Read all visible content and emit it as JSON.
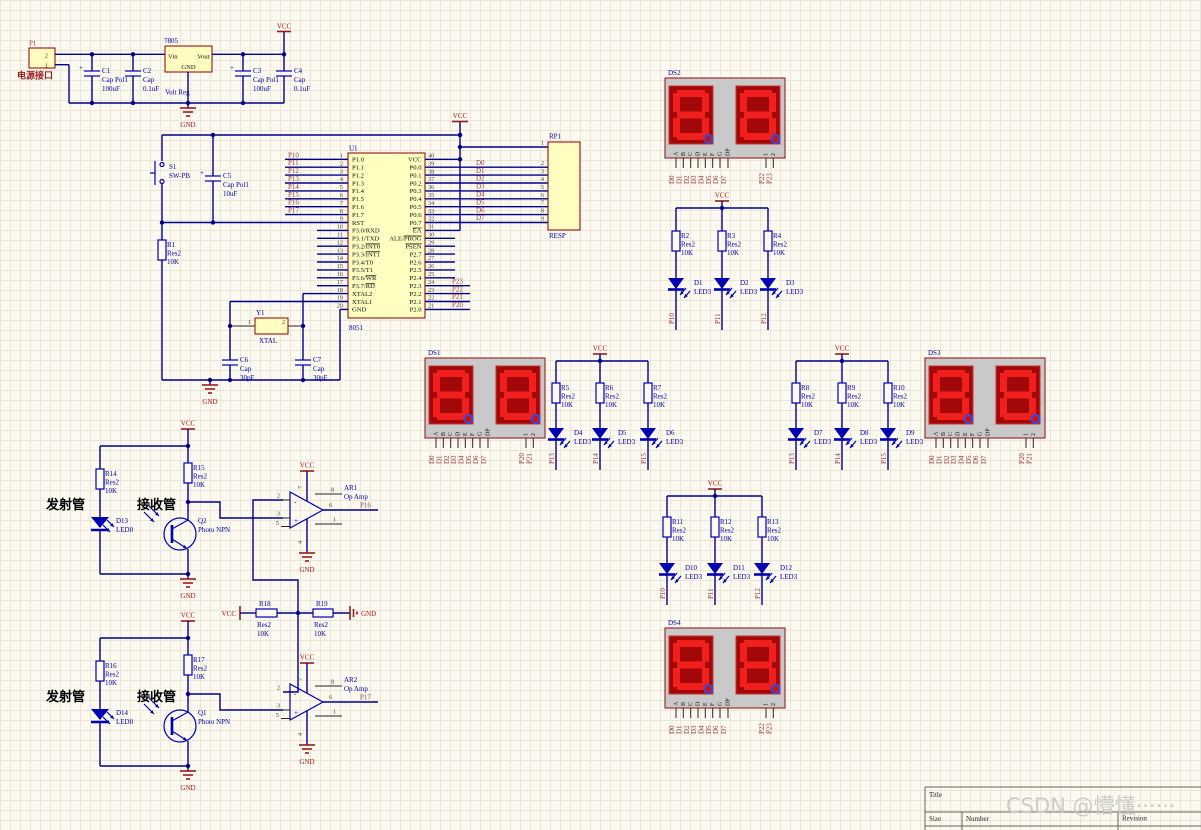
{
  "power": {
    "vcc": "VCC",
    "gnd": "GND"
  },
  "power_section": {
    "p1": {
      "ref": "P1",
      "label": "电源接口",
      "pin2": "2",
      "pin1": "1"
    },
    "c1": {
      "ref": "C1",
      "type": "Cap Pol1",
      "value": "100uF"
    },
    "c2": {
      "ref": "C2",
      "type": "Cap",
      "value": "0.1uF"
    },
    "vreg": {
      "ref": "7805",
      "pin_vin": "Vin",
      "pin_vout": "Vout",
      "pin_gnd": "GND",
      "desc": "Volt Reg"
    },
    "c3": {
      "ref": "C3",
      "type": "Cap Pol1",
      "value": "100uF"
    },
    "c4": {
      "ref": "C4",
      "type": "Cap",
      "value": "0.1uF"
    }
  },
  "reset_section": {
    "s1": {
      "ref": "S1",
      "value": "SW-PB"
    },
    "c5": {
      "ref": "C5",
      "type": "Cap Pol1",
      "value": "10uF"
    },
    "r1": {
      "ref": "R1",
      "type": "Res2",
      "value": "10K"
    }
  },
  "xtal_section": {
    "y1": {
      "ref": "Y1",
      "value": "XTAL",
      "pin1": "1",
      "pin2": "2"
    },
    "c6": {
      "ref": "C6",
      "type": "Cap",
      "value": "30pF"
    },
    "c7": {
      "ref": "C7",
      "type": "Cap",
      "value": "30pF"
    }
  },
  "mcu": {
    "ref": "U1",
    "value": "8051",
    "left_pins": [
      {
        "n": "1",
        "name": "P1.0",
        "net": "P10"
      },
      {
        "n": "2",
        "name": "P1.1",
        "net": "P11"
      },
      {
        "n": "3",
        "name": "P1.2",
        "net": "P12"
      },
      {
        "n": "4",
        "name": "P1.3",
        "net": "P13"
      },
      {
        "n": "5",
        "name": "P1.4",
        "net": "P14"
      },
      {
        "n": "6",
        "name": "P1.5",
        "net": "P15"
      },
      {
        "n": "7",
        "name": "P1.6",
        "net": "P16"
      },
      {
        "n": "8",
        "name": "P1.7",
        "net": "P17"
      },
      {
        "n": "9",
        "name": "RST"
      },
      {
        "n": "10",
        "name": "P3.0/RXD"
      },
      {
        "n": "11",
        "name": "P3.1/TXD"
      },
      {
        "n": "12",
        "name": "P3.2/INT0",
        "bar": "INT0"
      },
      {
        "n": "13",
        "name": "P3.3/INT1",
        "bar": "INT1"
      },
      {
        "n": "14",
        "name": "P3.4/T0"
      },
      {
        "n": "15",
        "name": "P3.5/T1"
      },
      {
        "n": "16",
        "name": "P3.6/WR",
        "bar": "WR"
      },
      {
        "n": "17",
        "name": "P3.7/RD",
        "bar": "RD"
      },
      {
        "n": "18",
        "name": "XTAL2"
      },
      {
        "n": "19",
        "name": "XTAL1"
      },
      {
        "n": "20",
        "name": "GND"
      }
    ],
    "right_pins": [
      {
        "n": "40",
        "name": "VCC"
      },
      {
        "n": "39",
        "name": "P0.0",
        "net": "D0"
      },
      {
        "n": "38",
        "name": "P0.1",
        "net": "D1"
      },
      {
        "n": "37",
        "name": "P0.2",
        "net": "D2"
      },
      {
        "n": "36",
        "name": "P0.3",
        "net": "D3"
      },
      {
        "n": "35",
        "name": "P0.4",
        "net": "D4"
      },
      {
        "n": "34",
        "name": "P0.5",
        "net": "D5"
      },
      {
        "n": "33",
        "name": "P0.6",
        "net": "D6"
      },
      {
        "n": "32",
        "name": "P0.7",
        "net": "D7"
      },
      {
        "n": "31",
        "name": "EA",
        "bar": "EA"
      },
      {
        "n": "30",
        "name": "ALE/PROG",
        "bar": "PROG"
      },
      {
        "n": "29",
        "name": "PSEN",
        "bar": "PSEN"
      },
      {
        "n": "28",
        "name": "P2.7"
      },
      {
        "n": "27",
        "name": "P2.6"
      },
      {
        "n": "26",
        "name": "P2.5"
      },
      {
        "n": "25",
        "name": "P2.4"
      },
      {
        "n": "24",
        "name": "P2.3",
        "net": "P23"
      },
      {
        "n": "23",
        "name": "P2.2",
        "net": "P22"
      },
      {
        "n": "22",
        "name": "P2.1",
        "net": "P21"
      },
      {
        "n": "21",
        "name": "P2.0",
        "net": "P20"
      }
    ]
  },
  "rp": {
    "ref": "RP1",
    "value": "RESP",
    "pin1": "1",
    "pins": [
      "2",
      "3",
      "4",
      "5",
      "6",
      "7",
      "8",
      "9"
    ]
  },
  "displays": [
    {
      "ref": "DS1",
      "segment_pins": [
        "A",
        "B",
        "C",
        "D",
        "E",
        "F",
        "G",
        "DP"
      ],
      "select_pins": [
        "1",
        "2"
      ],
      "segment_nets": [
        "D0",
        "D1",
        "D2",
        "D3",
        "D4",
        "D5",
        "D6",
        "D7"
      ],
      "select_nets": [
        "P20",
        "P21"
      ]
    },
    {
      "ref": "DS2",
      "segment_pins": [
        "A",
        "B",
        "C",
        "D",
        "E",
        "F",
        "G",
        "DP"
      ],
      "select_pins": [
        "1",
        "2"
      ],
      "segment_nets": [
        "D0",
        "D1",
        "D2",
        "D3",
        "D4",
        "D5",
        "D6",
        "D7"
      ],
      "select_nets": [
        "P22",
        "P23"
      ]
    },
    {
      "ref": "DS3",
      "segment_pins": [
        "A",
        "B",
        "C",
        "D",
        "E",
        "F",
        "G",
        "DP"
      ],
      "select_pins": [
        "1",
        "2"
      ],
      "segment_nets": [
        "D0",
        "D1",
        "D2",
        "D3",
        "D4",
        "D5",
        "D6",
        "D7"
      ],
      "select_nets": [
        "P20",
        "P21"
      ]
    },
    {
      "ref": "DS4",
      "segment_pins": [
        "A",
        "B",
        "C",
        "D",
        "E",
        "F",
        "G",
        "DP"
      ],
      "select_pins": [
        "1",
        "2"
      ],
      "segment_nets": [
        "D0",
        "D1",
        "D2",
        "D3",
        "D4",
        "D5",
        "D6",
        "D7"
      ],
      "select_nets": [
        "P22",
        "P23"
      ]
    }
  ],
  "led_groups": [
    {
      "resistors": [
        {
          "ref": "R2",
          "type": "Res2",
          "value": "10K"
        },
        {
          "ref": "R3",
          "type": "Res2",
          "value": "10K"
        },
        {
          "ref": "R4",
          "type": "Res2",
          "value": "10K"
        }
      ],
      "leds": [
        {
          "ref": "D1",
          "type": "LED3"
        },
        {
          "ref": "D2",
          "type": "LED3"
        },
        {
          "ref": "D3",
          "type": "LED3"
        }
      ],
      "nets": [
        "P10",
        "P11",
        "P12"
      ]
    },
    {
      "resistors": [
        {
          "ref": "R5",
          "type": "Res2",
          "value": "10K"
        },
        {
          "ref": "R6",
          "type": "Res2",
          "value": "10K"
        },
        {
          "ref": "R7",
          "type": "Res2",
          "value": "10K"
        }
      ],
      "leds": [
        {
          "ref": "D4",
          "type": "LED3"
        },
        {
          "ref": "D5",
          "type": "LED3"
        },
        {
          "ref": "D6",
          "type": "LED3"
        }
      ],
      "nets": [
        "P13",
        "P14",
        "P15"
      ]
    },
    {
      "resistors": [
        {
          "ref": "R8",
          "type": "Res2",
          "value": "10K"
        },
        {
          "ref": "R9",
          "type": "Res2",
          "value": "10K"
        },
        {
          "ref": "R10",
          "type": "Res2",
          "value": "10K"
        }
      ],
      "leds": [
        {
          "ref": "D7",
          "type": "LED3"
        },
        {
          "ref": "D8",
          "type": "LED3"
        },
        {
          "ref": "D9",
          "type": "LED3"
        }
      ],
      "nets": [
        "P13",
        "P14",
        "P15"
      ]
    },
    {
      "resistors": [
        {
          "ref": "R11",
          "type": "Res2",
          "value": "10K"
        },
        {
          "ref": "R12",
          "type": "Res2",
          "value": "10K"
        },
        {
          "ref": "R13",
          "type": "Res2",
          "value": "10K"
        }
      ],
      "leds": [
        {
          "ref": "D10",
          "type": "LED3"
        },
        {
          "ref": "D11",
          "type": "LED3"
        },
        {
          "ref": "D12",
          "type": "LED3"
        }
      ],
      "nets": [
        "P10",
        "P11",
        "P12"
      ]
    }
  ],
  "sensors": [
    {
      "emitter_label": "发射管",
      "receiver_label": "接收管",
      "r_emitter": {
        "ref": "R14",
        "type": "Res2",
        "value": "10K"
      },
      "r_receiver": {
        "ref": "R15",
        "type": "Res2",
        "value": "10K"
      },
      "led": {
        "ref": "D13",
        "type": "LED0"
      },
      "transistor": {
        "ref": "Q2",
        "type": "Photo NPN"
      },
      "opamp": {
        "ref": "AR1",
        "type": "Op Amp",
        "minus": "-",
        "plus": "+",
        "pins": {
          "inv": "2",
          "nin": "3",
          "p5": "5",
          "p8": "8",
          "out": "6",
          "p1": "1",
          "p7": "7",
          "p4": "4"
        }
      },
      "net": "P16"
    },
    {
      "emitter_label": "发射管",
      "receiver_label": "接收管",
      "r_emitter": {
        "ref": "R16",
        "type": "Res2",
        "value": "10K"
      },
      "r_receiver": {
        "ref": "R17",
        "type": "Res2",
        "value": "10K"
      },
      "led": {
        "ref": "D14",
        "type": "LED0"
      },
      "transistor": {
        "ref": "Q1",
        "type": "Photo NPN"
      },
      "opamp": {
        "ref": "AR2",
        "type": "Op Amp",
        "minus": "-",
        "plus": "+",
        "pins": {
          "inv": "2",
          "nin": "3",
          "p5": "5",
          "p8": "8",
          "out": "6",
          "p1": "1",
          "p7": "7",
          "p4": "4"
        }
      },
      "net": "P17"
    }
  ],
  "divider": {
    "r18": {
      "ref": "R18",
      "type": "Res2",
      "value": "10K"
    },
    "r19": {
      "ref": "R19",
      "type": "Res2",
      "value": "10K"
    }
  },
  "title_block": {
    "title_label": "Title",
    "size_label": "Size",
    "size": "A2",
    "number_label": "Number",
    "revision_label": "Revision"
  },
  "watermark": "CSDN @懵懂······"
}
